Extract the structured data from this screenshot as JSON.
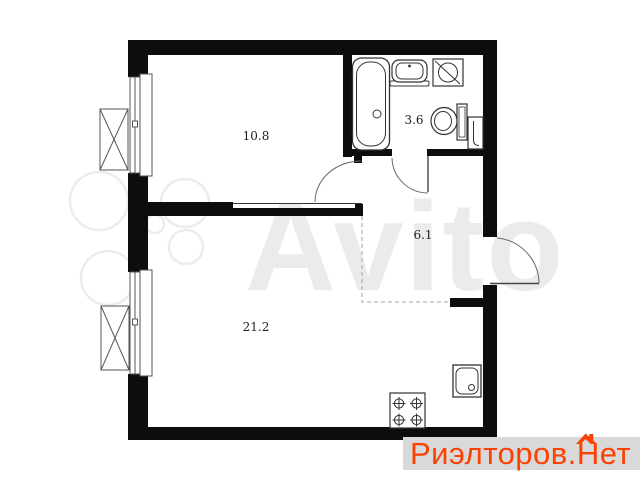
{
  "canvas": {
    "width": 640,
    "height": 480,
    "background": "#ffffff"
  },
  "floorplan": {
    "wall_color": "#0d0d0d",
    "line_color": "#555555",
    "rooms": [
      {
        "name": "room",
        "area_label": "10.8"
      },
      {
        "name": "bathroom",
        "area_label": "3.6"
      },
      {
        "name": "hallway",
        "area_label": "6.1"
      },
      {
        "name": "living-kitchen",
        "area_label": "21.2"
      }
    ],
    "fixture_icons": [
      "bathtub-icon",
      "washbasin-icon",
      "washing-machine-icon",
      "toilet-icon",
      "water-heater-icon",
      "stove-icon",
      "kitchen-sink-icon"
    ],
    "feature_icons": [
      "window-icon",
      "ac-basket-icon",
      "door-swing-icon",
      "kitchen-zone-dashed-boundary"
    ]
  },
  "watermarks": {
    "avito": {
      "text": "Avito",
      "color": "#ebebeb"
    },
    "realtor": {
      "part1": "Риэлторов.",
      "part2": "Н",
      "part3": "ет",
      "text_color": "#fb4203",
      "background": "#d9d9d9"
    }
  }
}
